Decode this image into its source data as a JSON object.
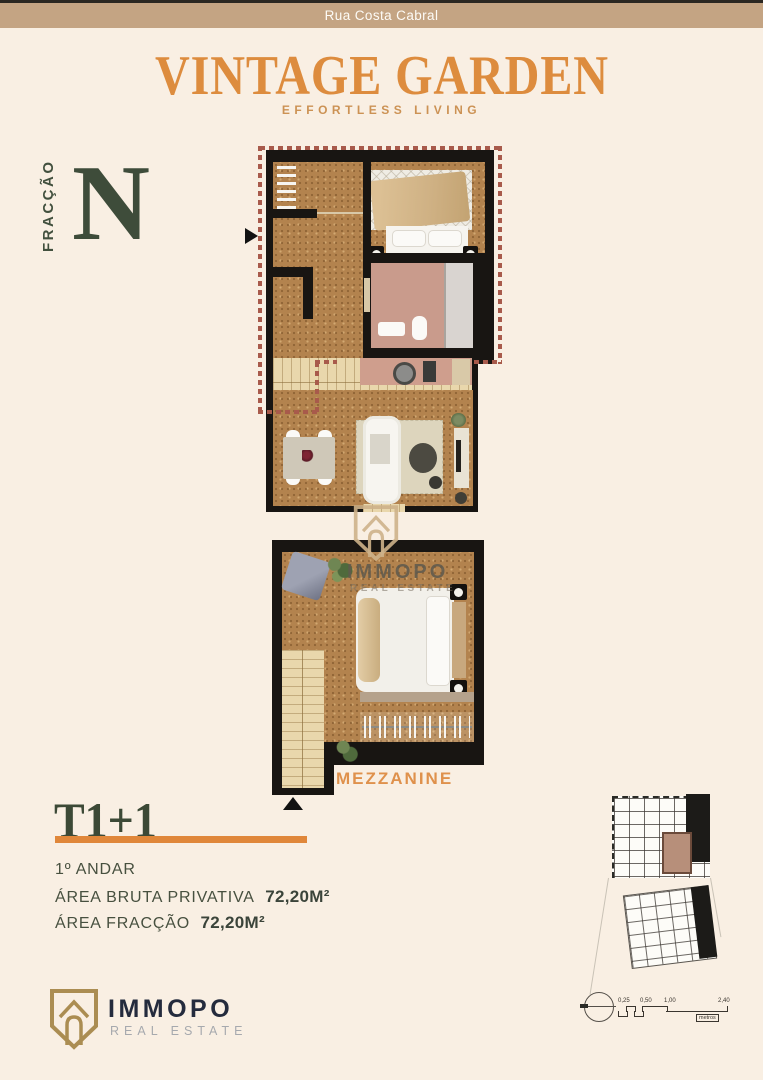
{
  "header": {
    "street": "Rua Costa Cabral",
    "title": "VINTAGE GARDEN",
    "subtitle": "EFFORTLESS LIVING"
  },
  "fraction": {
    "label": "FRACÇÃO",
    "letter": "N"
  },
  "plan": {
    "mezzanine_label": "MEZZANINE"
  },
  "details": {
    "typology": "T1+1",
    "floor": "1º ANDAR",
    "areas": [
      {
        "label": "ÁREA BRUTA PRIVATIVA",
        "value": "72,20M²"
      },
      {
        "label": "ÁREA FRACÇÃO",
        "value": "72,20M²"
      }
    ]
  },
  "watermark": {
    "brand": "IMMOPO",
    "tagline": "REAL ESTATE"
  },
  "footer": {
    "brand": "IMMOPO",
    "tagline": "REAL ESTATE"
  },
  "siteplan": {
    "scale_labels": [
      "0,25",
      "0,50",
      "1,00",
      "2,40"
    ],
    "unit": "metros"
  },
  "colors": {
    "background": "#f9efe3",
    "street_bar": "#c4a483",
    "title_orange": "#dd8c3e",
    "accent_orange": "#e0873a",
    "dark_green": "#3e4c3a",
    "dash_red": "#a85a4b",
    "wall_black": "#181512",
    "cork_floor": "#b3834e"
  }
}
